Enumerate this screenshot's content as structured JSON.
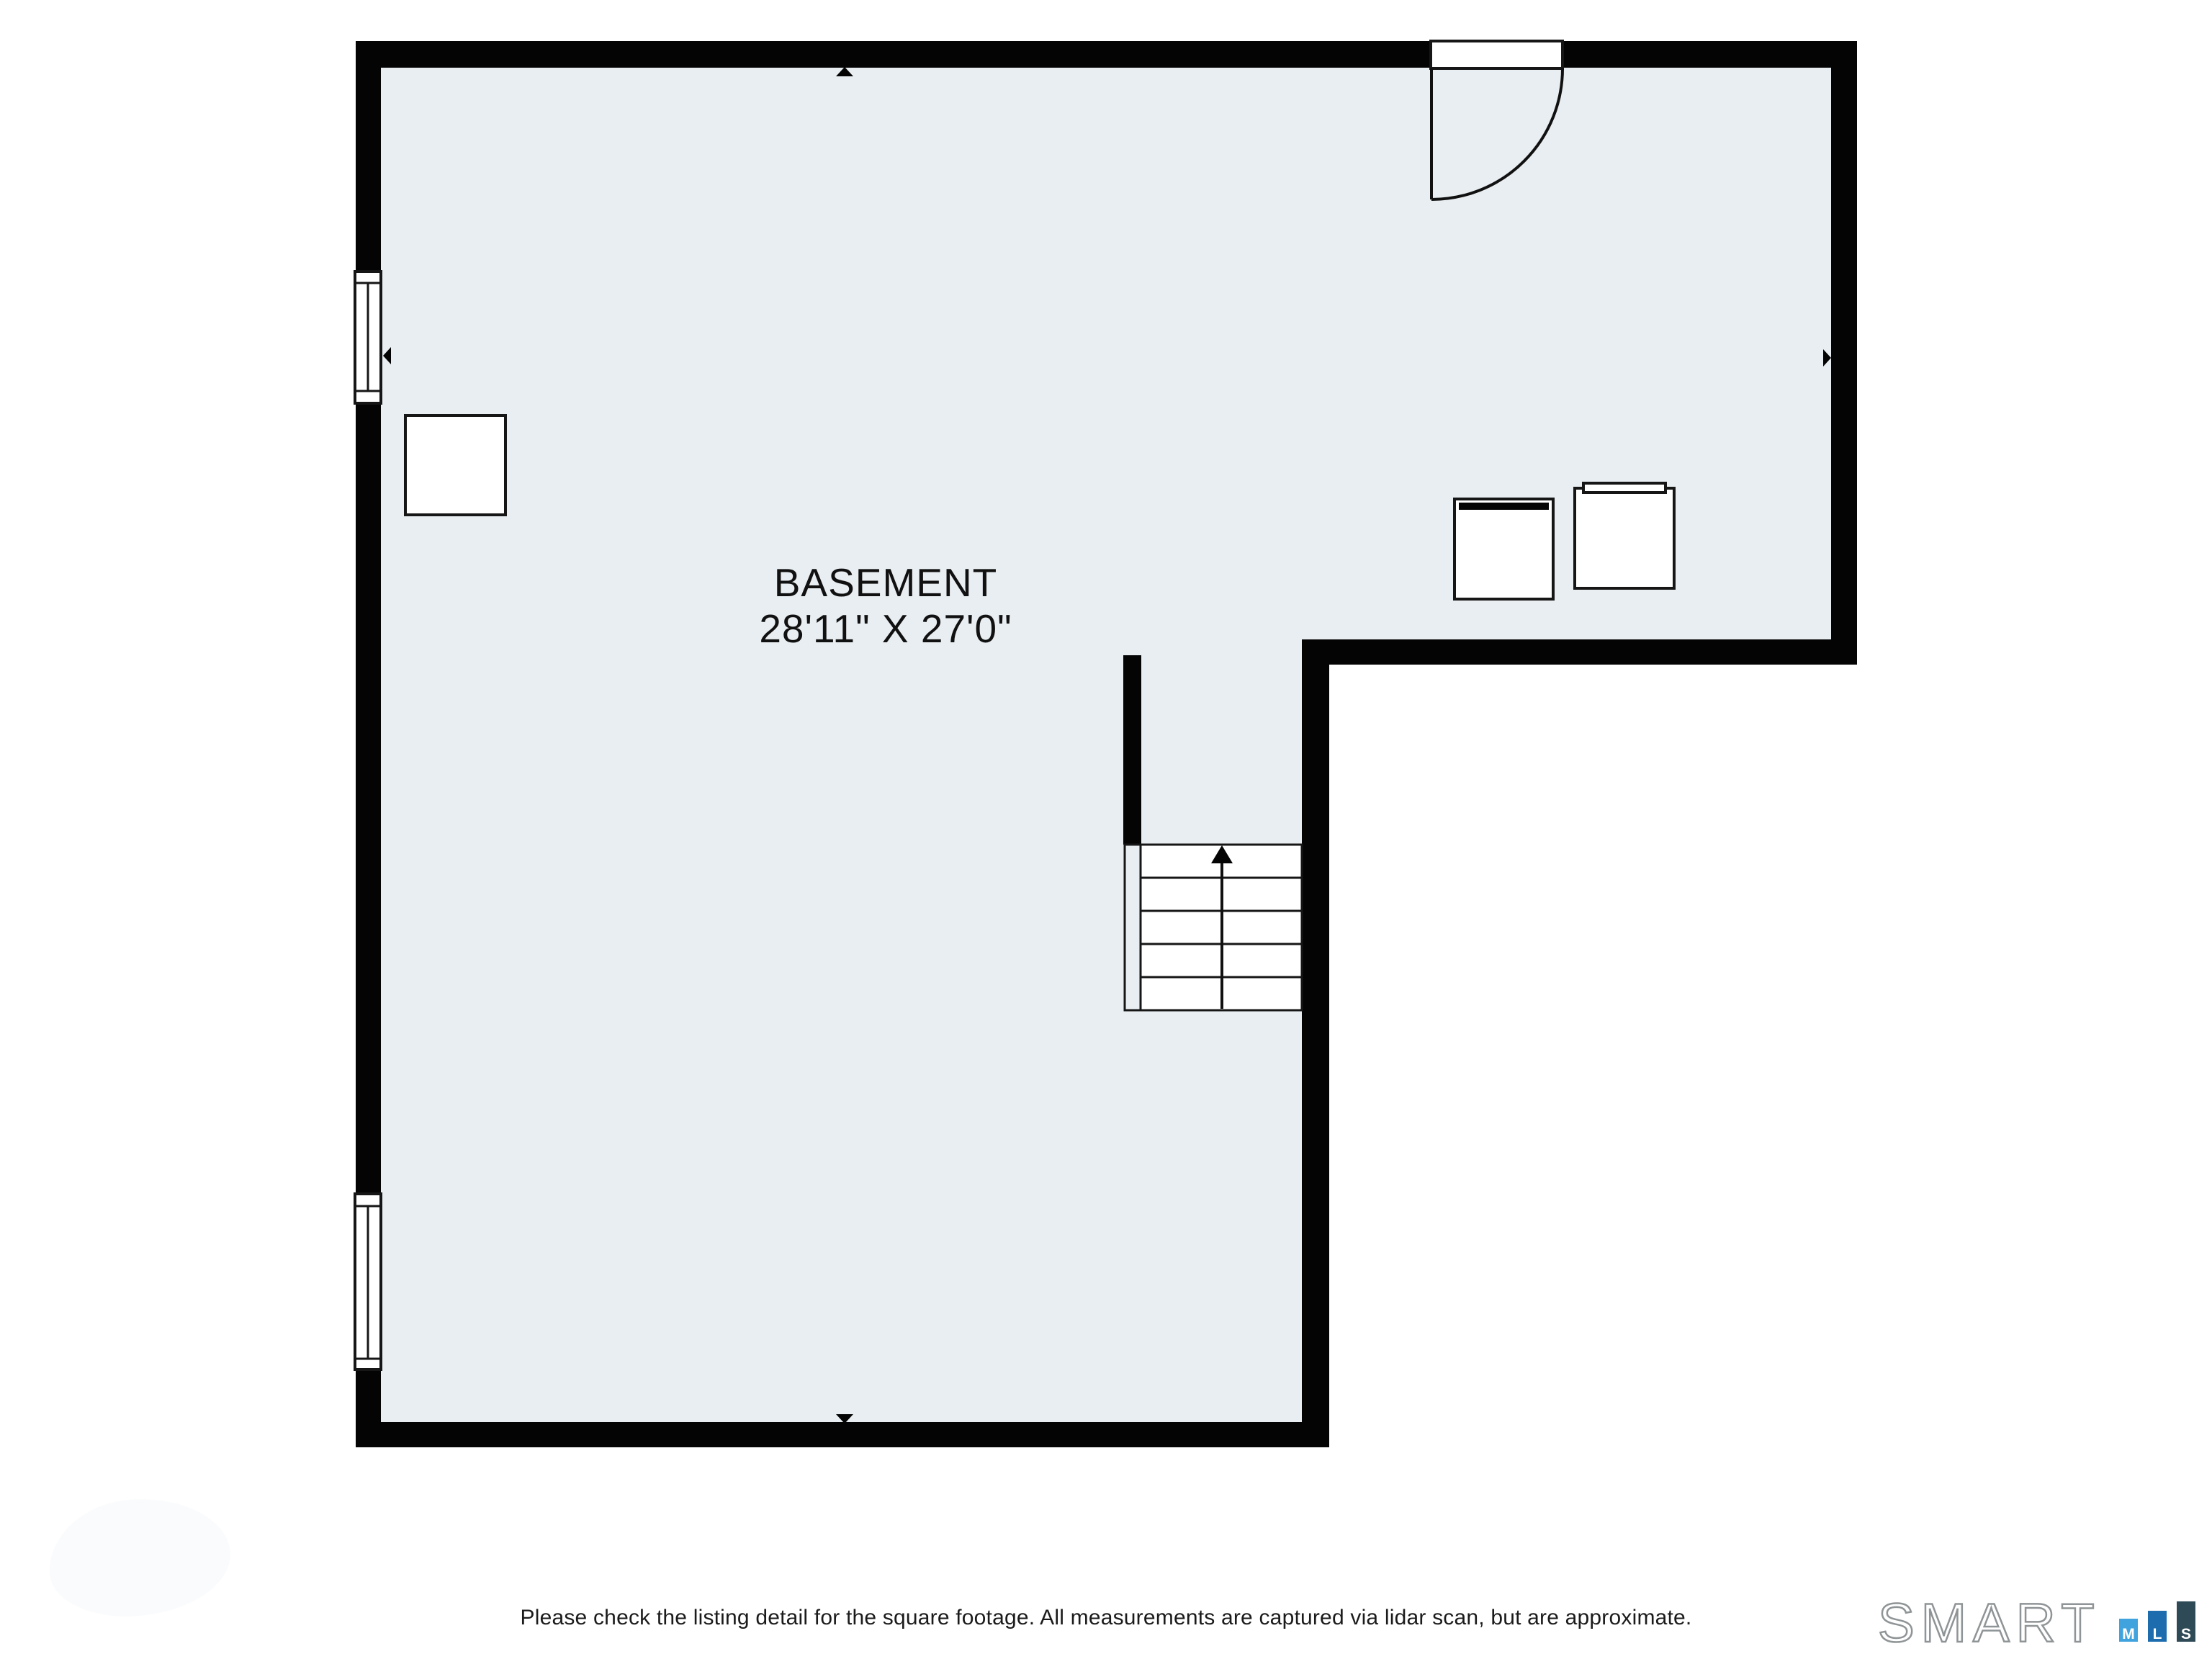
{
  "plan": {
    "room": {
      "label": "BASEMENT",
      "dimensions": "28'11\" X 27'0\""
    },
    "colors": {
      "floor_fill": "#e9eef2",
      "wall": "#040404",
      "background": "#ffffff"
    }
  },
  "footer": {
    "disclaimer": "Please check the listing detail for the square footage. All measurements are captured via lidar scan, but are approximate."
  },
  "logo": {
    "wordmark": "SMART",
    "outline_color": "#8f9496",
    "bars": [
      {
        "letter": "M",
        "color": "#41a3de"
      },
      {
        "letter": "L",
        "color": "#1d6dae"
      },
      {
        "letter": "S",
        "color": "#2e4a57"
      }
    ]
  }
}
